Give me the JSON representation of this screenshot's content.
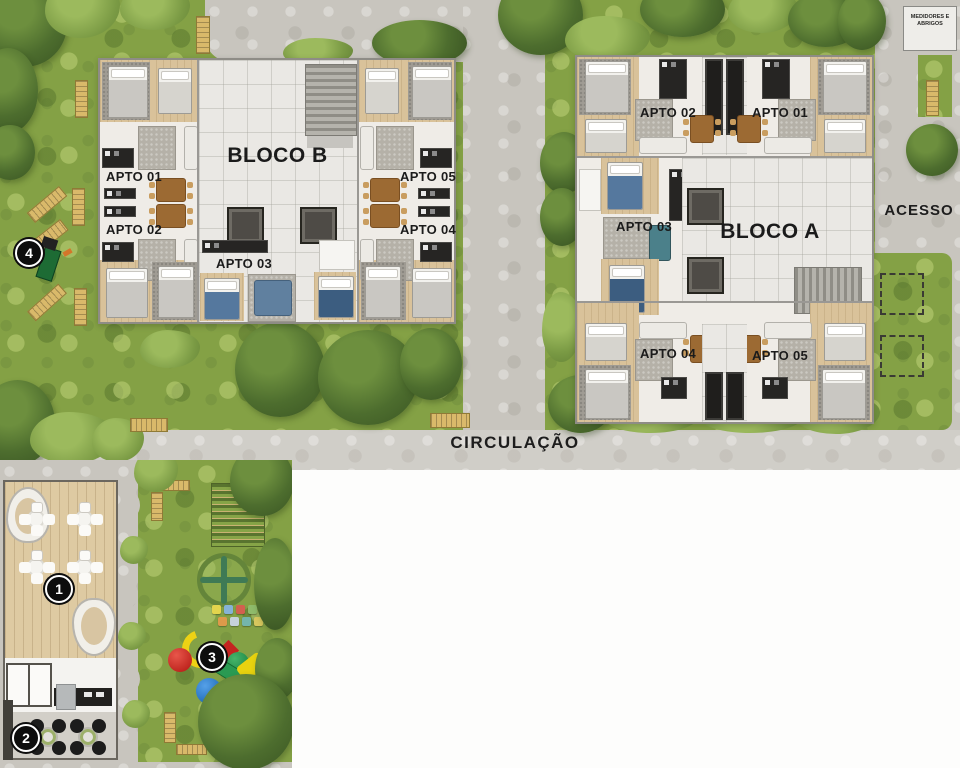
{
  "blocks": {
    "b": {
      "name": "BLOCO B",
      "apartments": [
        "APTO 01",
        "APTO 02",
        "APTO 03",
        "APTO 04",
        "APTO 05"
      ]
    },
    "a": {
      "name": "BLOCO A",
      "apartments": [
        "APTO 01",
        "APTO 02",
        "APTO 03",
        "APTO 04",
        "APTO 05"
      ]
    }
  },
  "labels": {
    "circulation": "CIRCULAÇÃO",
    "access": "ACESSO",
    "meters": "MEDIDORES E ABRIGOS"
  },
  "markers": [
    {
      "number": "1",
      "area": "gourmet-deck"
    },
    {
      "number": "2",
      "area": "barbecue-patio"
    },
    {
      "number": "3",
      "area": "playground"
    },
    {
      "number": "4",
      "area": "garden-feature"
    }
  ],
  "colors": {
    "grass": "#84a145",
    "tree_dark": "#46652a",
    "paving": "#c8c5be",
    "building_floor": "#efece7",
    "hall_floor": "#eae8e4",
    "wood": "#d9c29a",
    "deck_wood": "#decaa2",
    "bench": "#d9b96a",
    "marker_bg": "#0d0d0d",
    "marker_text": "#ffffff",
    "bed_blue": "#55789e",
    "play_red": "#cf2a1f",
    "play_yellow": "#edd214",
    "play_green": "#2a9a52",
    "play_blue": "#1e7bd0"
  }
}
